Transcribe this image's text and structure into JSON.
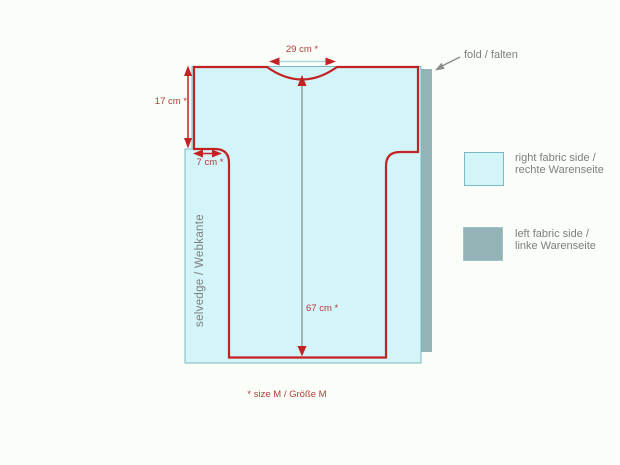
{
  "diagram": {
    "fold_label": "fold / falten",
    "selvedge_label": "selvedge / Webkante",
    "size_note": "* size M / Größe M",
    "dimensions": {
      "neck_width": "29 cm *",
      "shoulder_to_underarm": "17 cm *",
      "underarm_inset": "7 cm *",
      "body_length": "67 cm *"
    }
  },
  "legend": {
    "items": [
      {
        "label_en": "right fabric side /",
        "label_de": "rechte Warenseite",
        "swatch_color": "#d3f4f9"
      },
      {
        "label_en": "left fabric side /",
        "label_de": "linke Warenseite",
        "swatch_color": "#93b4b6"
      }
    ]
  },
  "colors": {
    "background": "#fbfdf9",
    "fabric_right_side": "#d3f4f9",
    "fabric_left_side": "#93b4b6",
    "fabric_edge": "#7cb9c2",
    "pattern_outline": "#c32222",
    "dimension_text": "#b23b3b",
    "annotation_gray": "#7d7f7d",
    "center_line_gray": "#90a0a0"
  }
}
